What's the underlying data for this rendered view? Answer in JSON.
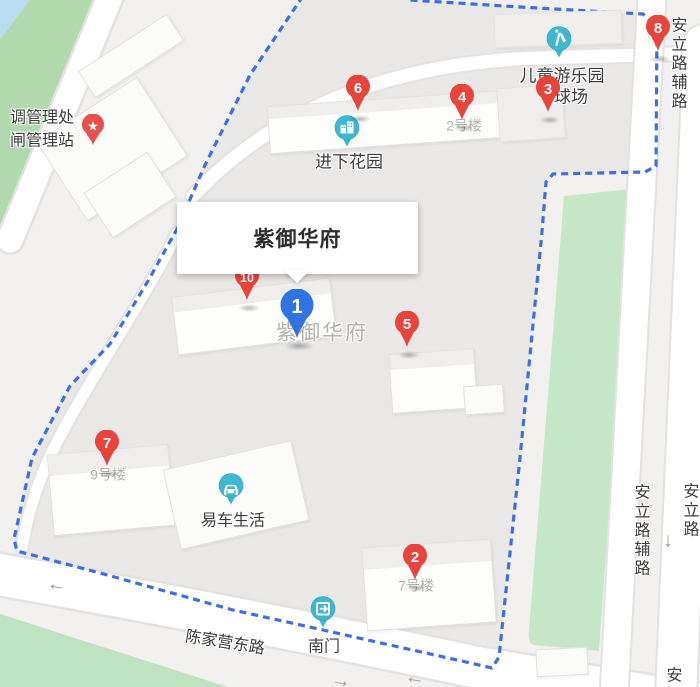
{
  "colors": {
    "land": "#f2f1ef",
    "compound": "#e9e8e6",
    "road": "#ffffff",
    "road-casing": "#e3e2e0",
    "water": "#b8dcf0",
    "green-left": "#b2d8ae",
    "green-right": "#c6e6c8",
    "green-bottom": "#bfe2c0",
    "boundary": "#3f6ee2",
    "marker-red": "#e9443c",
    "marker-blue": "#2f74e0",
    "poi-teal": "#3eb7d0",
    "star-pin-red": "#e8514b",
    "label-dark": "#3c3c3c",
    "label-gray": "#b3b2b0",
    "info-title": "#2d2d2d"
  },
  "info_box": {
    "title": "紫御华府"
  },
  "markers": [
    {
      "num": "1",
      "type": "blue",
      "x": 297,
      "y": 344
    },
    {
      "num": "2",
      "type": "red",
      "x": 415,
      "y": 586
    },
    {
      "num": "3",
      "type": "red",
      "x": 548,
      "y": 118
    },
    {
      "num": "4",
      "type": "red",
      "x": 462,
      "y": 126
    },
    {
      "num": "5",
      "type": "red",
      "x": 407,
      "y": 353
    },
    {
      "num": "6",
      "type": "red",
      "x": 358,
      "y": 117
    },
    {
      "num": "7",
      "type": "red",
      "x": 107,
      "y": 472
    },
    {
      "num": "8",
      "type": "red",
      "x": 658,
      "y": 57
    },
    {
      "num": "10",
      "type": "red",
      "x": 247,
      "y": 306
    }
  ],
  "pois": [
    {
      "id": "children-playground",
      "icon": "playground-icon",
      "x": 559,
      "y": 64,
      "labels": [
        {
          "text": "儿童游乐园",
          "x": 562,
          "y": 76,
          "cls": "big"
        },
        {
          "text": "球场",
          "x": 571,
          "y": 97,
          "cls": "big"
        }
      ]
    },
    {
      "id": "jinxia-garden",
      "icon": "residence-icon",
      "x": 347,
      "y": 153,
      "labels": [
        {
          "text": "进下花园",
          "x": 349,
          "y": 162,
          "cls": "big"
        }
      ]
    },
    {
      "id": "yiche-life",
      "icon": "car-icon",
      "x": 231,
      "y": 511,
      "labels": [
        {
          "text": "易车生活",
          "x": 233,
          "y": 521,
          "cls": ""
        }
      ]
    },
    {
      "id": "south-gate",
      "icon": "gate-icon",
      "x": 323,
      "y": 634,
      "labels": [
        {
          "text": "南门",
          "x": 324,
          "y": 647,
          "cls": ""
        }
      ]
    },
    {
      "id": "management-station",
      "icon": "star-pin",
      "x": 93,
      "y": 151,
      "labels": [
        {
          "text": "调管理处",
          "x": 42,
          "y": 118,
          "cls": ""
        },
        {
          "text": "闸管理站",
          "x": 42,
          "y": 141,
          "cls": ""
        }
      ]
    }
  ],
  "building_labels": [
    {
      "text": "2号楼",
      "x": 464,
      "y": 126,
      "cls": "gray"
    },
    {
      "text": "7号楼",
      "x": 416,
      "y": 586,
      "cls": "gray"
    },
    {
      "text": "9号楼",
      "x": 108,
      "y": 475,
      "cls": "gray"
    },
    {
      "text": "紫御华府",
      "x": 322,
      "y": 333,
      "cls": "gray-large"
    }
  ],
  "road_labels": [
    {
      "text": "陈家营东路",
      "x": 225,
      "y": 643,
      "rotate": 9
    },
    {
      "text": "安立路辅路",
      "x": 677,
      "y": 64,
      "vertical": true
    },
    {
      "text": "安立路辅路",
      "x": 640,
      "y": 531,
      "vertical": true
    },
    {
      "text": "安立路",
      "x": 689,
      "y": 511,
      "vertical": true
    },
    {
      "text": "安",
      "x": 672,
      "y": 676,
      "vertical": true
    }
  ],
  "road_arrows": [
    {
      "glyph": "←",
      "x": 57,
      "y": 585,
      "rotate": 9
    },
    {
      "glyph": "→",
      "x": 341,
      "y": 681,
      "rotate": 9
    },
    {
      "glyph": "←",
      "x": 415,
      "y": 678,
      "rotate": 9
    },
    {
      "glyph": "↓",
      "x": 668,
      "y": 541,
      "rotate": 0
    }
  ]
}
